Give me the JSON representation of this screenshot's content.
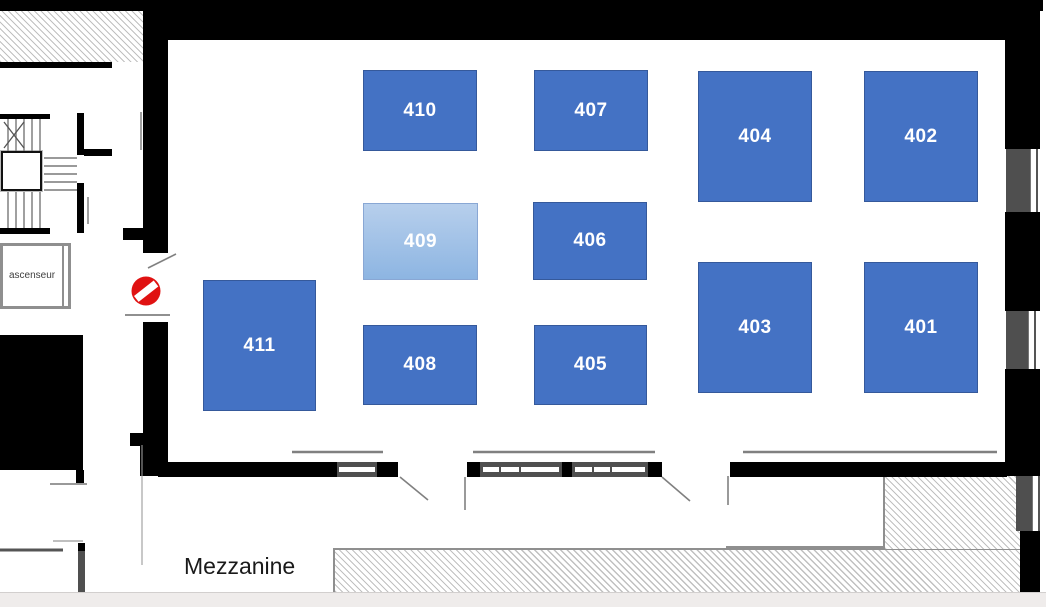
{
  "floor_plan": {
    "rooms": [
      {
        "label": "401",
        "style": "dark"
      },
      {
        "label": "402",
        "style": "dark"
      },
      {
        "label": "403",
        "style": "dark"
      },
      {
        "label": "404",
        "style": "dark"
      },
      {
        "label": "405",
        "style": "dark"
      },
      {
        "label": "406",
        "style": "dark"
      },
      {
        "label": "407",
        "style": "dark"
      },
      {
        "label": "408",
        "style": "dark"
      },
      {
        "label": "409",
        "style": "light-highlighted"
      },
      {
        "label": "410",
        "style": "dark"
      },
      {
        "label": "411",
        "style": "dark"
      }
    ],
    "texts": {
      "mezzanine": "Mezzanine",
      "elevator": "ascenseur"
    },
    "icons": [
      {
        "name": "no-entry-icon",
        "meaning": "no entry / access forbidden at corridor opening"
      }
    ],
    "colors": {
      "room_fill": "#4472c4",
      "room_border": "#35599b",
      "room_highlight_top": "#b7cfec",
      "room_highlight_bottom": "#8db5e2",
      "wall": "#000000",
      "no_entry_red": "#e01212",
      "hatch_line": "#c0c0c0",
      "window_panel": "#4f4f4f",
      "bottom_bar": "#efeceb"
    }
  }
}
